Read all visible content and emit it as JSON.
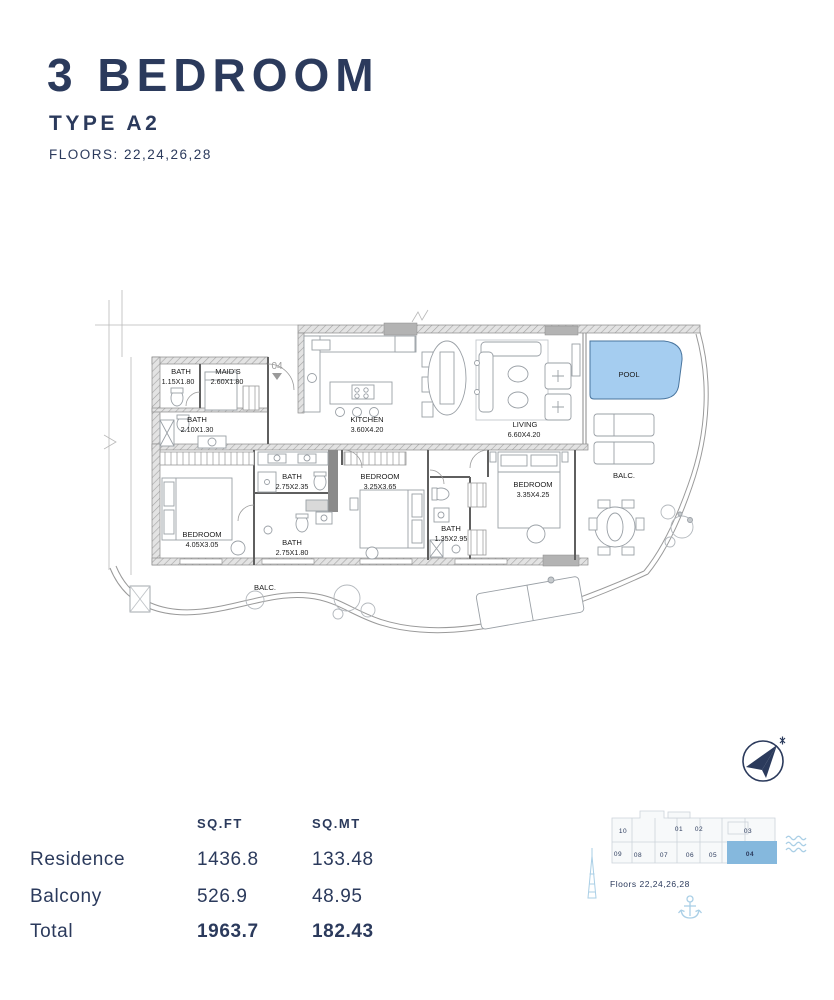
{
  "header": {
    "title": "3 BEDROOM",
    "type": "TYPE A2",
    "floors": "FLOORS: 22,24,26,28"
  },
  "plan": {
    "unit_marker": "04",
    "rooms": [
      {
        "name": "BATH",
        "dims": "1.15X1.80"
      },
      {
        "name": "MAID'S",
        "dims": "2.60X1.80"
      },
      {
        "name": "BATH",
        "dims": "2.10X1.30"
      },
      {
        "name": "KITCHEN",
        "dims": "3.60X4.20"
      },
      {
        "name": "LIVING",
        "dims": "6.60X4.20"
      },
      {
        "name": "POOL",
        "dims": ""
      },
      {
        "name": "BALC.",
        "dims": ""
      },
      {
        "name": "BATH",
        "dims": "2.75X2.35"
      },
      {
        "name": "BEDROOM",
        "dims": "3.25X3.65"
      },
      {
        "name": "BEDROOM",
        "dims": "3.35X4.25"
      },
      {
        "name": "BATH",
        "dims": "1.35X2.95"
      },
      {
        "name": "BATH",
        "dims": "2.75X1.80"
      },
      {
        "name": "BEDROOM",
        "dims": "4.05X3.05"
      },
      {
        "name": "BALC.",
        "dims": ""
      }
    ]
  },
  "areas": {
    "header": [
      "SQ.FT",
      "SQ.MT"
    ],
    "rows": [
      {
        "label": "Residence",
        "sqft": "1436.8",
        "sqmt": "133.48"
      },
      {
        "label": "Balcony",
        "sqft": "526.9",
        "sqmt": "48.95"
      },
      {
        "label": "Total",
        "sqft": "1963.7",
        "sqmt": "182.43"
      }
    ]
  },
  "keyplan": {
    "caption": "Floors 22,24,26,28",
    "highlighted_unit": "04",
    "units_top": [
      "10",
      "01",
      "02",
      "03"
    ],
    "units_bottom": [
      "09",
      "08",
      "07",
      "06",
      "05",
      "04"
    ]
  },
  "icons": {
    "compass": "north-compass",
    "tower": "tower-landmark",
    "anchor": "anchor",
    "waves": "sea-waves"
  },
  "colors": {
    "navy": "#2b3a5c",
    "pool_blue": "#a5cdf0",
    "keyplan_blue": "#85b8dd",
    "light_blue": "#aacfe6",
    "wall_gray": "#b3b3b3"
  }
}
